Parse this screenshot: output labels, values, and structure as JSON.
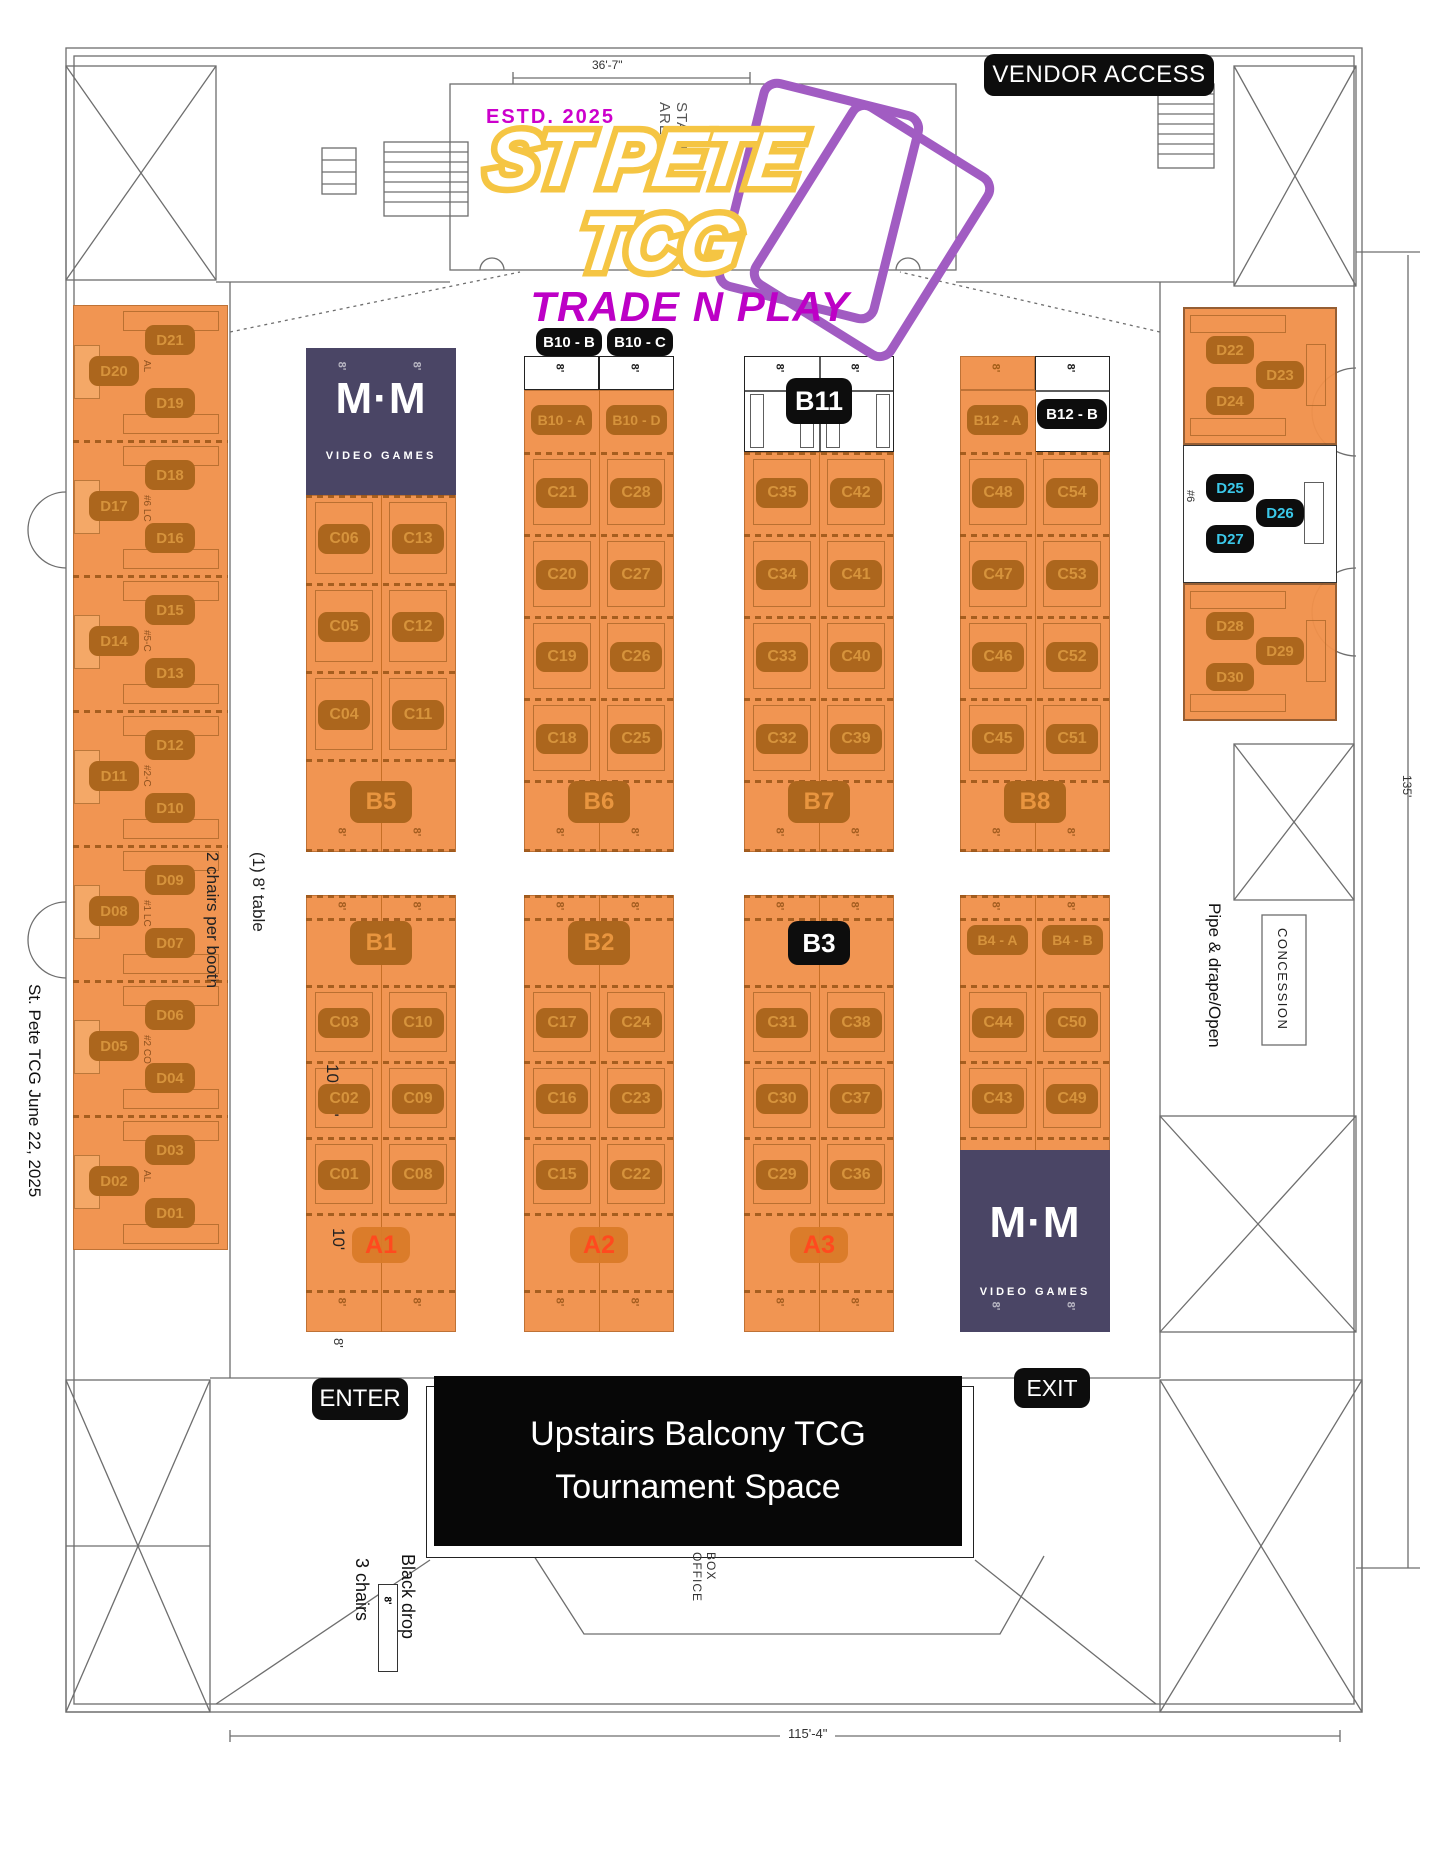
{
  "badges": {
    "vendor_access": "VENDOR ACCESS",
    "enter": "ENTER",
    "exit": "EXIT"
  },
  "logo": {
    "estd": "ESTD. 2025",
    "line1": "ST PETE",
    "line2": "TCG",
    "subtitle": "TRADE N PLAY"
  },
  "banner": {
    "line1": "Upstairs Balcony TCG",
    "line2": "Tournament Space"
  },
  "mm": {
    "monogram": "M·M",
    "name": "VIDEO GAMES"
  },
  "annotations": {
    "stage_area": "STAGE AREA",
    "left_date": "St. Pete TCG June 22, 2025",
    "table_note_line1": "(1) 8' table",
    "table_note_line2": "2 chairs per booth",
    "booth_size": "10' x 8'",
    "ten_ft": "10'",
    "eight_ft": "8'",
    "black_drop": "Black drop",
    "three_chairs": "3 chairs",
    "box_office": "BOX OFFICE",
    "pipe_drape": "Pipe & drape/Open",
    "concession": "CONCESSION",
    "dim_top": "36'-7\"",
    "dim_bottom": "115'-4\"",
    "dim_right": "135'"
  },
  "left_column": {
    "groups": [
      {
        "right_top": "D21",
        "left": "D20",
        "right_bottom": "D19",
        "note": "AL"
      },
      {
        "right_top": "D18",
        "left": "D17",
        "right_bottom": "D16",
        "note": "#6 LC"
      },
      {
        "right_top": "D15",
        "left": "D14",
        "right_bottom": "D13",
        "note": "#5-C"
      },
      {
        "right_top": "D12",
        "left": "D11",
        "right_bottom": "D10",
        "note": "#2-C"
      },
      {
        "right_top": "D09",
        "left": "D08",
        "right_bottom": "D07",
        "note": "#1 LC"
      },
      {
        "right_top": "D06",
        "left": "D05",
        "right_bottom": "D04",
        "note": "#2 CO"
      },
      {
        "right_top": "D03",
        "left": "D02",
        "right_bottom": "D01",
        "note": "AL"
      }
    ]
  },
  "right_column": {
    "top_square": {
      "top_left": "D22",
      "right": "D23",
      "bottom_left": "D24"
    },
    "mid_square": {
      "top_left": "D25",
      "right": "D26",
      "bottom_left": "D27",
      "note": "#6"
    },
    "bottom_square": {
      "top_left": "D28",
      "right": "D29",
      "bottom_left": "D30"
    }
  },
  "top_clusters": [
    {
      "badge": "B5",
      "header": "mm",
      "rows": [
        [
          "C06",
          "C13"
        ],
        [
          "C05",
          "C12"
        ],
        [
          "C04",
          "C11"
        ]
      ]
    },
    {
      "badge": "B6",
      "header_badges": [
        "B10 - B",
        "B10 - C"
      ],
      "header_cells": [
        "B10 - A",
        "B10 - D"
      ],
      "rows": [
        [
          "C21",
          "C28"
        ],
        [
          "C20",
          "C27"
        ],
        [
          "C19",
          "C26"
        ],
        [
          "C18",
          "C25"
        ]
      ]
    },
    {
      "badge": "B7",
      "header_badge": "B11",
      "rows": [
        [
          "C35",
          "C42"
        ],
        [
          "C34",
          "C41"
        ],
        [
          "C33",
          "C40"
        ],
        [
          "C32",
          "C39"
        ]
      ]
    },
    {
      "badge": "B8",
      "header_cells": [
        "B12 - A",
        "B12 - B"
      ],
      "rows": [
        [
          "C48",
          "C54"
        ],
        [
          "C47",
          "C53"
        ],
        [
          "C46",
          "C52"
        ],
        [
          "C45",
          "C51"
        ]
      ]
    }
  ],
  "bottom_clusters": [
    {
      "badge": "B1",
      "rows": [
        [
          "C03",
          "C10"
        ],
        [
          "C02",
          "C09"
        ],
        [
          "C01",
          "C08"
        ]
      ],
      "a_label": "A1"
    },
    {
      "badge": "B2",
      "rows": [
        [
          "C17",
          "C24"
        ],
        [
          "C16",
          "C23"
        ],
        [
          "C15",
          "C22"
        ]
      ],
      "a_label": "A2"
    },
    {
      "badge": "B3",
      "badge_style": "black",
      "rows": [
        [
          "C31",
          "C38"
        ],
        [
          "C30",
          "C37"
        ],
        [
          "C29",
          "C36"
        ]
      ],
      "a_label": "A3"
    },
    {
      "badge_cells": [
        "B4 - A",
        "B4 - B"
      ],
      "rows": [
        [
          "C44",
          "C50"
        ],
        [
          "C43",
          "C49"
        ]
      ],
      "footer": "mm"
    }
  ],
  "colors": {
    "booth_orange": "#F0914B",
    "chip_brown": "#AC661D",
    "chip_text": "#D6933C",
    "mm_block": "#4A4565",
    "badge_black": "#0D0D0D",
    "cyan": "#3BC8E9",
    "magenta": "#BD00C6",
    "logo_yellow": "#F5C543",
    "logo_purple": "#A15CC2",
    "a_text": "#FF4A1E"
  }
}
